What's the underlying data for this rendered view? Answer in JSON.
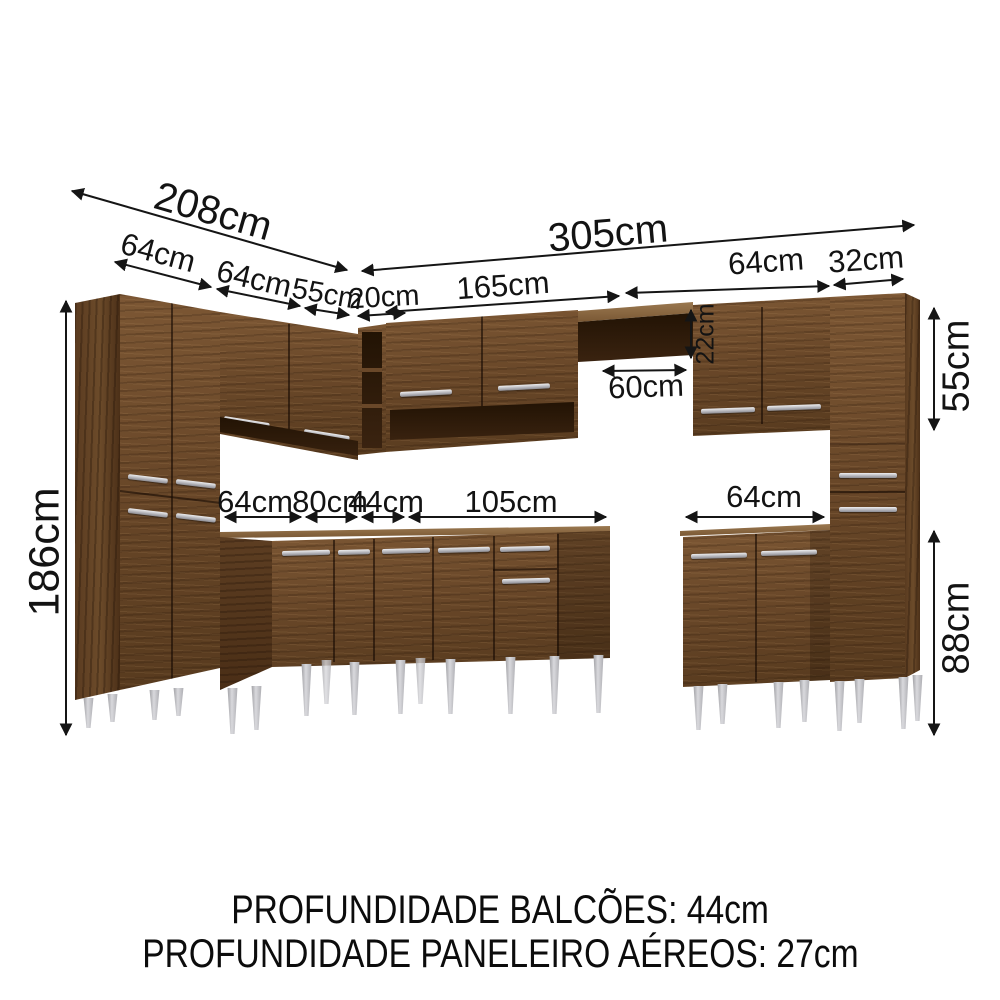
{
  "labels": {
    "d208": "208cm",
    "d64a": "64cm",
    "d64b": "64cm",
    "d55a": "55cm",
    "d20": "20cm",
    "d305": "305cm",
    "d165": "165cm",
    "d64c": "64cm",
    "d32": "32cm",
    "d22": "22cm",
    "d60": "60cm",
    "d55r": "55cm",
    "d88": "88cm",
    "d186": "186cm",
    "d64base": "64cm",
    "d80": "80cm",
    "d44": "44cm",
    "d105": "105cm",
    "d64rbase": "64cm"
  },
  "footer": {
    "line1": "PROFUNDIDADE BALCÕES: 44cm",
    "line2": "PROFUNDIDADE PANELEIRO AÉREOS: 27cm"
  },
  "colors": {
    "wood": "#6a4829",
    "wood_dark": "#4c3018",
    "interior": "#2a1808",
    "legs": "#b9b9bd",
    "dimension_text": "#131313",
    "background": "#ffffff"
  }
}
